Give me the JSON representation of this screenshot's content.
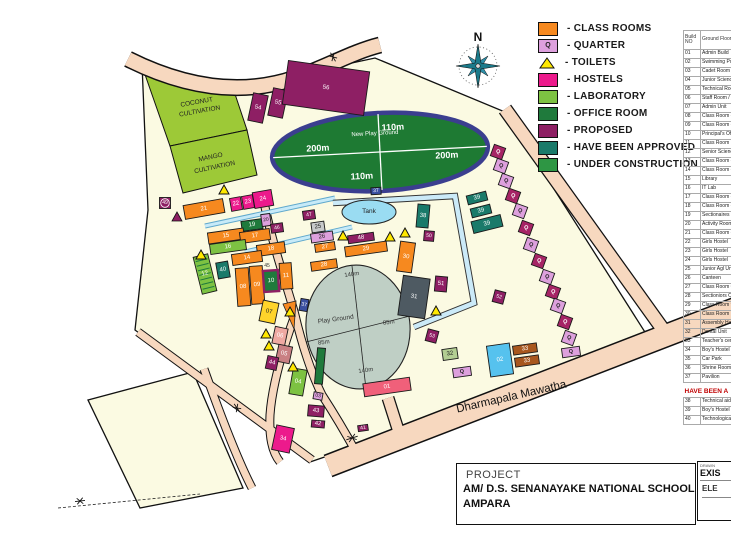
{
  "colors": {
    "classroom": "#F6891F",
    "quarter_light": "#DDA0DD",
    "quarter_dark": "#A62465",
    "toilet": "#FFE800",
    "hostel": "#EC1A8C",
    "lab": "#7DC242",
    "office": "#1F7A3C",
    "proposed": "#8E1F64",
    "approved": "#1A7A6A",
    "under_construction": "#2E9644",
    "grey": "#C8CACB",
    "dark_grey": "#4E5A62",
    "pool_blue": "#56C2EE",
    "brown": "#A8571E",
    "admin_red": "#F0607A",
    "yellow_bld": "#FFD42A",
    "salmon_bld": "#EFA9A2",
    "rose_bld": "#C98083",
    "pale_green": "#B3CE93",
    "pavilion": "#3A4FA0",
    "campus": "#FBFAE2",
    "road": "#F7D8BF",
    "cultivation": "#9DC937",
    "oval_green": "#1E7A33",
    "oval_border": "#3B3E8F",
    "ground_grey": "#BFCFC5",
    "tank_blue": "#9ADCF2"
  },
  "legend": {
    "items": [
      {
        "label": "- CLASS ROOMS",
        "type": "classroom"
      },
      {
        "label": "- QUARTER",
        "type": "quarter_light",
        "glyph": "Q"
      },
      {
        "label": "- TOILETS",
        "type": "toilet",
        "shape": "triangle"
      },
      {
        "label": "- HOSTELS",
        "type": "hostel"
      },
      {
        "label": "- LABORATORY",
        "type": "lab"
      },
      {
        "label": "- OFFICE ROOM",
        "type": "office"
      },
      {
        "label": "- PROPOSED",
        "type": "proposed"
      },
      {
        "label": "- HAVE BEEN APPROVED",
        "type": "approved"
      },
      {
        "label": "- UNDER CONSTRUCTION",
        "type": "under_construction"
      }
    ]
  },
  "compass": {
    "label": "N"
  },
  "map": {
    "buildings": [
      [
        "21",
        "classroom",
        204,
        209,
        40,
        14,
        -10
      ],
      [
        "22",
        "hostel",
        236,
        204,
        11,
        13,
        -10
      ],
      [
        "23",
        "hostel",
        248,
        202,
        11,
        13,
        -10
      ],
      [
        "24",
        "hostel",
        263,
        199,
        19,
        16,
        -10
      ],
      [
        "19",
        "office",
        252,
        225,
        21,
        10,
        -8
      ],
      [
        "20",
        "quarter_light",
        266,
        220,
        9,
        12,
        -8
      ],
      [
        "46",
        "proposed",
        277,
        228,
        12,
        9,
        -8
      ],
      [
        "15",
        "classroom",
        226,
        236,
        36,
        11,
        -8
      ],
      [
        "17",
        "classroom",
        255,
        236,
        30,
        11,
        -8
      ],
      [
        "16",
        "lab",
        228,
        247,
        36,
        10,
        -8
      ],
      [
        "18",
        "classroom",
        271,
        249,
        28,
        11,
        -8
      ],
      [
        "14",
        "classroom",
        247,
        258,
        30,
        11,
        -8
      ],
      [
        "40",
        "approved",
        223,
        270,
        12,
        16,
        -10
      ],
      [
        "12",
        "lab",
        205,
        274,
        15,
        38,
        -14
      ],
      [
        "08",
        "classroom",
        243,
        287,
        13,
        38,
        -4
      ],
      [
        "09",
        "classroom",
        257,
        285,
        13,
        38,
        -4
      ],
      [
        "10",
        "office",
        271,
        281,
        15,
        21,
        -4
      ],
      [
        "11",
        "classroom",
        286,
        276,
        12,
        26,
        -4
      ],
      [
        "49",
        "proposed",
        165,
        203,
        11,
        11,
        0
      ],
      [
        "47",
        "proposed",
        309,
        215,
        12,
        9,
        -8
      ],
      [
        "25",
        "grey",
        318,
        227,
        13,
        10,
        -8
      ],
      [
        "26",
        "quarter_light",
        322,
        237,
        22,
        9,
        -8
      ],
      [
        "27",
        "classroom",
        325,
        247,
        20,
        8,
        -8
      ],
      [
        "28",
        "classroom",
        324,
        265,
        26,
        9,
        -8
      ],
      [
        "48",
        "proposed",
        361,
        238,
        26,
        8,
        -8
      ],
      [
        "29",
        "classroom",
        366,
        249,
        42,
        10,
        -8
      ],
      [
        "30",
        "classroom",
        406,
        257,
        15,
        30,
        8
      ],
      [
        "38",
        "approved",
        423,
        216,
        12,
        23,
        5
      ],
      [
        "50",
        "proposed",
        429,
        236,
        10,
        10,
        5
      ],
      [
        "39",
        "approved",
        477,
        198,
        20,
        9,
        -14
      ],
      [
        "39",
        "approved",
        481,
        211,
        20,
        9,
        -14
      ],
      [
        "39",
        "approved",
        487,
        224,
        30,
        12,
        -14
      ],
      [
        "31",
        "dark_grey",
        414,
        297,
        27,
        40,
        8
      ],
      [
        "51",
        "proposed",
        441,
        284,
        12,
        15,
        5
      ],
      [
        "52",
        "proposed",
        499,
        297,
        11,
        12,
        15
      ],
      [
        "53",
        "proposed",
        432,
        336,
        11,
        12,
        15
      ],
      [
        "37",
        "pavilion",
        376,
        191,
        10,
        7,
        -3
      ],
      [
        "37",
        "pavilion",
        304,
        305,
        8,
        12,
        10
      ],
      [
        "01",
        "admin_red",
        387,
        387,
        47,
        13,
        -8
      ],
      [
        "02",
        "pool_blue",
        500,
        360,
        23,
        31,
        -8
      ],
      [
        "32",
        "pale_green",
        450,
        354,
        15,
        11,
        -8
      ],
      [
        "33",
        "brown",
        525,
        349,
        24,
        9,
        -8
      ],
      [
        "33",
        "brown",
        527,
        361,
        24,
        9,
        -8
      ],
      [
        "07",
        "yellow_bld",
        269,
        312,
        16,
        21,
        12
      ],
      [
        "06",
        "salmon_bld",
        280,
        336,
        13,
        17,
        12
      ],
      [
        "05",
        "rose_bld",
        284,
        354,
        14,
        17,
        12
      ],
      [
        "44",
        "proposed",
        272,
        363,
        11,
        13,
        12
      ],
      [
        "04",
        "lab",
        298,
        382,
        14,
        26,
        10
      ],
      [
        "03",
        "quarter_light",
        318,
        396,
        9,
        7,
        10
      ],
      [
        "43",
        "proposed",
        316,
        411,
        16,
        11,
        5
      ],
      [
        "42",
        "proposed",
        318,
        424,
        13,
        7,
        5
      ],
      [
        "34",
        "hostel",
        283,
        439,
        18,
        25,
        12
      ],
      [
        "41",
        "proposed",
        363,
        428,
        10,
        6,
        -8
      ],
      [
        "54",
        "proposed",
        258,
        108,
        15,
        28,
        12
      ],
      [
        "55",
        "proposed",
        278,
        103,
        15,
        28,
        12
      ],
      [
        "56",
        "proposed",
        326,
        88,
        82,
        44,
        8
      ],
      [
        "",
        "office",
        320,
        366,
        8,
        36,
        5
      ]
    ],
    "quarters": [
      [
        498,
        152,
        "d"
      ],
      [
        501,
        166,
        "l"
      ],
      [
        506,
        181,
        "l"
      ],
      [
        513,
        196,
        "d"
      ],
      [
        520,
        211,
        "l"
      ],
      [
        526,
        228,
        "d"
      ],
      [
        531,
        245,
        "l"
      ],
      [
        539,
        261,
        "d"
      ],
      [
        547,
        277,
        "l"
      ],
      [
        553,
        292,
        "d"
      ],
      [
        558,
        306,
        "l"
      ],
      [
        565,
        322,
        "d"
      ],
      [
        569,
        338,
        "l"
      ],
      [
        462,
        372,
        "l",
        "h"
      ],
      [
        571,
        352,
        "l",
        "h"
      ]
    ],
    "quarter_glyph": "Q",
    "toilets": [
      [
        224,
        190
      ],
      [
        201,
        255
      ],
      [
        343,
        236
      ],
      [
        390,
        237
      ],
      [
        405,
        233
      ],
      [
        436,
        311
      ],
      [
        266,
        334
      ],
      [
        269,
        346
      ],
      [
        293,
        367
      ],
      [
        290,
        312
      ]
    ],
    "proposed_marker": [
      177,
      217
    ],
    "labels": [
      [
        "COCONUT",
        197,
        104,
        6.5,
        "#222",
        -10,
        "normal"
      ],
      [
        "CULTIVATION",
        200,
        113,
        6.5,
        "#222",
        -10,
        "normal"
      ],
      [
        "MANGO",
        211,
        159,
        6.5,
        "#222",
        -12,
        "normal"
      ],
      [
        "CULTIVATION",
        215,
        169,
        6.5,
        "#222",
        -12,
        "normal"
      ],
      [
        "New Play Ground",
        375,
        135,
        6,
        "#fff",
        -3,
        "normal"
      ],
      [
        "200m",
        318,
        151,
        9,
        "#fff",
        -3,
        "bold"
      ],
      [
        "200m",
        447,
        158,
        9,
        "#fff",
        -3,
        "bold"
      ],
      [
        "110m",
        393,
        130,
        9,
        "#fff",
        -3,
        "bold"
      ],
      [
        "110m",
        362,
        179,
        9,
        "#fff",
        -3,
        "bold"
      ],
      [
        "Tank",
        369,
        213,
        6.5,
        "#222",
        0,
        "normal"
      ],
      [
        "Play Ground",
        336,
        321,
        6.5,
        "#333",
        -8,
        "normal"
      ],
      [
        "140m",
        352,
        276,
        6,
        "#333",
        -8,
        "normal"
      ],
      [
        "140m",
        366,
        372,
        6,
        "#333",
        -8,
        "normal"
      ],
      [
        "85m",
        324,
        344,
        6,
        "#333",
        -8,
        "normal"
      ],
      [
        "85m",
        389,
        324,
        6,
        "#333",
        -8,
        "normal"
      ],
      [
        "45",
        267,
        267,
        5,
        "#333",
        0,
        "normal"
      ],
      [
        "Dharmapala Mawatha",
        512,
        400,
        11.5,
        "#111",
        -13,
        "normal"
      ]
    ]
  },
  "building_table": {
    "header_line1": "Build",
    "header_line2": "NO",
    "header_col2": "Ground Floor",
    "rows": [
      [
        "01",
        "Admin Build"
      ],
      [
        "02",
        "Swimming Pool"
      ],
      [
        "03",
        "Cadet Room"
      ],
      [
        "04",
        "Junior Science La"
      ],
      [
        "05",
        "Technical Room/"
      ],
      [
        "06",
        "Staff Room / Cla"
      ],
      [
        "07",
        "Admin Unit"
      ],
      [
        "08",
        "Class Room - 10"
      ],
      [
        "09",
        "Class Room - 13"
      ],
      [
        "10",
        "Principal's Offic"
      ],
      [
        "11",
        "Class Room"
      ],
      [
        "12",
        "Senior Science U"
      ],
      [
        "13",
        "Class Room - 13"
      ],
      [
        "14",
        "Class Room - 12"
      ],
      [
        "15",
        "Library"
      ],
      [
        "16",
        "IT Lab"
      ],
      [
        "17",
        "Class Room - 08"
      ],
      [
        "18",
        "Class Room - 07"
      ],
      [
        "19",
        "Sectionaires Offic"
      ],
      [
        "20",
        "Activity Rooms"
      ],
      [
        "21",
        "Class Room - 6"
      ],
      [
        "22",
        "Girls Hostel"
      ],
      [
        "23",
        "Girls Hostel"
      ],
      [
        "24",
        "Girls Hostel"
      ],
      [
        "25",
        "Junior Agl Unit"
      ],
      [
        "26",
        "Canteen"
      ],
      [
        "27",
        "Class Room Com"
      ],
      [
        "28",
        "Sectioniors Offic B"
      ],
      [
        "29",
        "Class Room 9/10"
      ],
      [
        "30",
        "Class Room 11"
      ],
      [
        "31",
        "Assembly Hall (S"
      ],
      [
        "32",
        "Dental Unit"
      ],
      [
        "33",
        "Teacher's center"
      ],
      [
        "34",
        "Boy's Hostel"
      ],
      [
        "35",
        "Car Park"
      ],
      [
        "36",
        "Shrine Room"
      ],
      [
        "37",
        "Pavilion"
      ]
    ],
    "approved_heading": "HAVE BEEN A",
    "approved_rows": [
      [
        "38",
        "Technical aid Co"
      ],
      [
        "39",
        "Boy's Hostel"
      ],
      [
        "40",
        "Technological/La"
      ]
    ]
  },
  "title_block": {
    "project_label": "PROJECT",
    "school": "AM/ D.S. SENANAYAKE NATIONAL SCHOOL",
    "city": "AMPARA",
    "drawn_label": "DRAWN",
    "code_top": "EXIS",
    "code_bottom": "ELE"
  }
}
